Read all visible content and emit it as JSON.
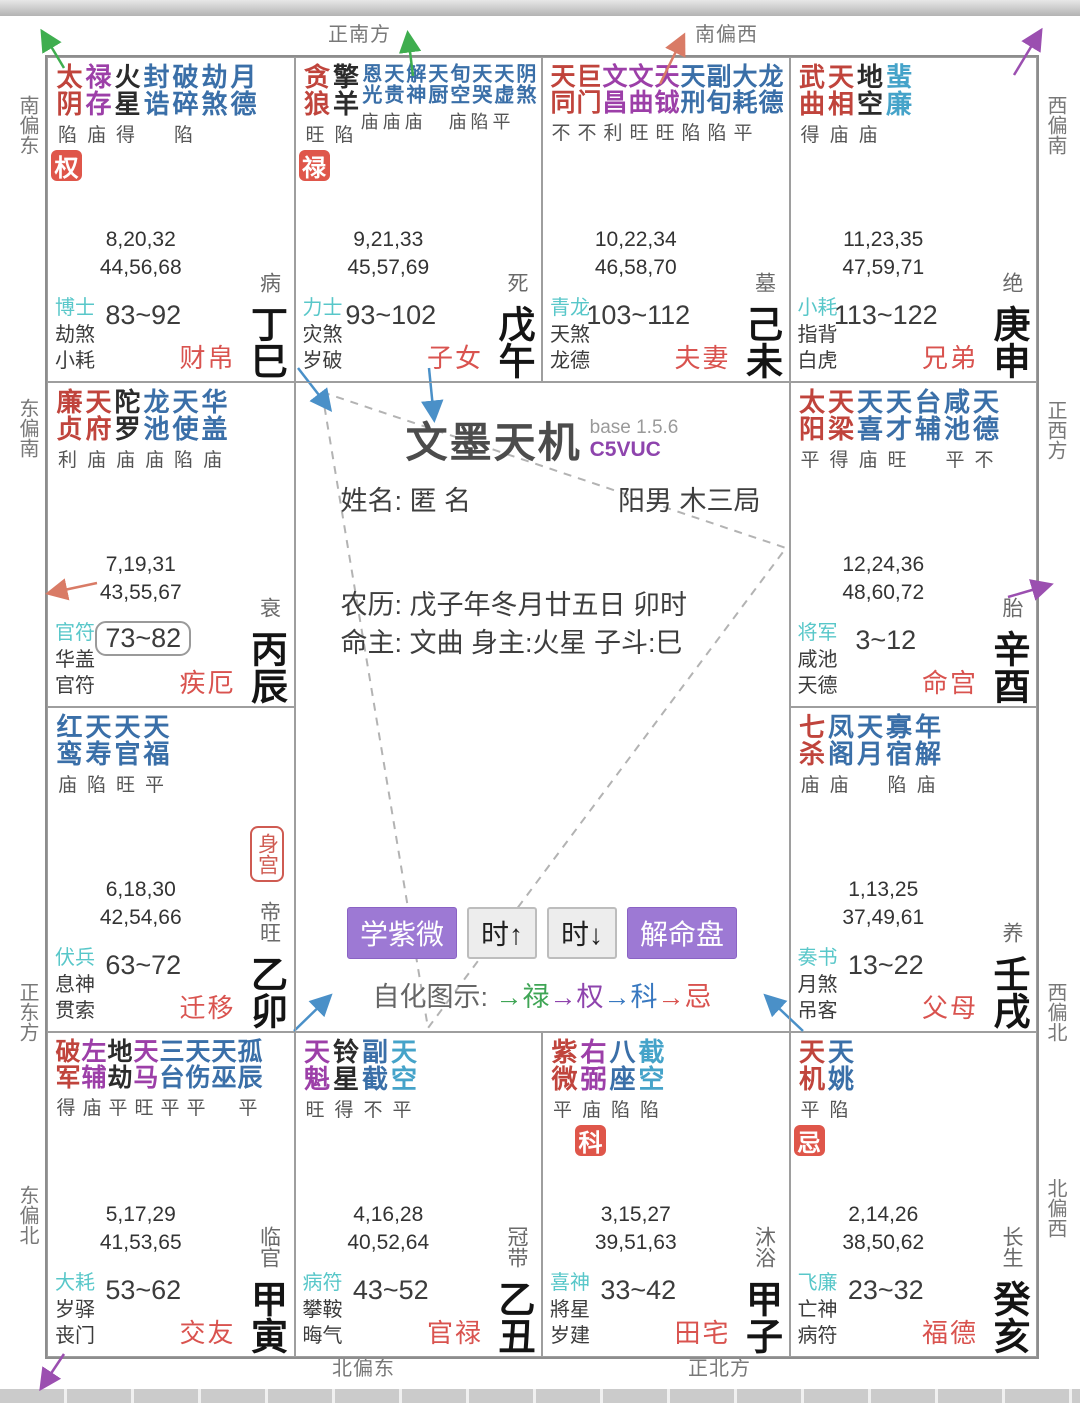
{
  "app": {
    "title": "文墨天机",
    "version": "base 1.5.6",
    "code": "C5VUC"
  },
  "info": {
    "name_line": "姓名: 匿 名",
    "gender_bureau": "阳男 木三局",
    "lunar": "农历: 戊子年冬月廿五日 卯时",
    "masters": "命主: 文曲 身主:火星 子斗:巳"
  },
  "toolbar": {
    "buttons": [
      {
        "label": "学紫微"
      },
      {
        "label": "时↑"
      },
      {
        "label": "时↓"
      },
      {
        "label": "解命盘"
      }
    ]
  },
  "legend": {
    "label": "自化图示:",
    "items": [
      {
        "text": "→禄",
        "color": "#3fa555"
      },
      {
        "text": "→权",
        "color": "#8e44ad"
      },
      {
        "text": "→科",
        "color": "#3878c0"
      },
      {
        "text": "→忌",
        "color": "#d9534f"
      }
    ]
  },
  "compass": {
    "top": [
      "正南方",
      "南偏西"
    ],
    "bottom": [
      "北偏东",
      "正北方"
    ],
    "left": [
      "南偏东",
      "东偏南",
      "正东方",
      "东偏北"
    ],
    "right": [
      "西偏南",
      "正西方",
      "西偏北",
      "北偏西"
    ]
  },
  "colors": {
    "major_star": "#c0443c",
    "lucky_star": "#9c3fa8",
    "malefic_star": "#2b2b2b",
    "minor_star": "#3a6fa8",
    "minor_star_light": "#45a3c9",
    "hua_badge": "#df564a",
    "deity": "#58c7c9",
    "palace_name": "#d9534f",
    "accent_purple": "#9d79d4"
  },
  "palaces": [
    {
      "branch": "si",
      "col": 1,
      "row": 1,
      "stars": [
        {
          "n": "太阴",
          "c": "major",
          "b": "陷"
        },
        {
          "n": "禄存",
          "c": "lucky",
          "b": "庙"
        },
        {
          "n": "火星",
          "c": "malefic",
          "b": "得"
        },
        {
          "n": "封诰",
          "c": "minor",
          "b": ""
        },
        {
          "n": "破碎",
          "c": "minor",
          "b": "陷"
        },
        {
          "n": "劫煞",
          "c": "minor",
          "b": ""
        },
        {
          "n": "月德",
          "c": "minor",
          "b": ""
        }
      ],
      "hua": {
        "label": "权",
        "col": 0
      },
      "numbers": [
        "8,20,32",
        "44,56,68"
      ],
      "deities": [
        "博士",
        "劫煞",
        "小耗"
      ],
      "range": "83~92",
      "boxed": false,
      "stage": "病",
      "name": "财帛",
      "stem": "丁巳"
    },
    {
      "branch": "wu",
      "col": 2,
      "row": 1,
      "stars": [
        {
          "n": "贪狼",
          "c": "major",
          "b": "旺"
        },
        {
          "n": "擎羊",
          "c": "malefic",
          "b": "陷"
        },
        {
          "n": "恩光",
          "c": "minor",
          "b": "庙",
          "s": "sm"
        },
        {
          "n": "天贵",
          "c": "minor",
          "b": "庙",
          "s": "sm"
        },
        {
          "n": "解神",
          "c": "minor",
          "b": "庙",
          "s": "sm"
        },
        {
          "n": "天厨",
          "c": "minor",
          "b": "",
          "s": "sm"
        },
        {
          "n": "旬空",
          "c": "minor",
          "b": "庙",
          "s": "sm"
        },
        {
          "n": "天哭",
          "c": "minor",
          "b": "陷",
          "s": "sm"
        },
        {
          "n": "天虚",
          "c": "minor",
          "b": "平",
          "s": "sm"
        },
        {
          "n": "阴煞",
          "c": "minor",
          "b": "",
          "s": "sm"
        }
      ],
      "hua": {
        "label": "禄",
        "col": 0
      },
      "numbers": [
        "9,21,33",
        "45,57,69"
      ],
      "deities": [
        "力士",
        "灾煞",
        "岁破"
      ],
      "range": "93~102",
      "boxed": false,
      "stage": "死",
      "name": "子女",
      "stem": "戊午"
    },
    {
      "branch": "wei",
      "col": 3,
      "row": 1,
      "tight": true,
      "stars": [
        {
          "n": "天同",
          "c": "major",
          "b": "不"
        },
        {
          "n": "巨门",
          "c": "major",
          "b": "不"
        },
        {
          "n": "文昌",
          "c": "lucky",
          "b": "利"
        },
        {
          "n": "文曲",
          "c": "lucky",
          "b": "旺"
        },
        {
          "n": "天钺",
          "c": "lucky",
          "b": "旺"
        },
        {
          "n": "天刑",
          "c": "minor",
          "b": "陷"
        },
        {
          "n": "副旬",
          "c": "minor",
          "b": "陷"
        },
        {
          "n": "大耗",
          "c": "minor",
          "b": "平"
        },
        {
          "n": "龙德",
          "c": "minor",
          "b": ""
        }
      ],
      "numbers": [
        "10,22,34",
        "46,58,70"
      ],
      "deities": [
        "青龙",
        "天煞",
        "龙德"
      ],
      "range": "103~112",
      "boxed": false,
      "stage": "墓",
      "name": "夫妻",
      "stem": "己未"
    },
    {
      "branch": "shen",
      "col": 4,
      "row": 1,
      "stars": [
        {
          "n": "武曲",
          "c": "major",
          "b": "得"
        },
        {
          "n": "天相",
          "c": "major",
          "b": "庙"
        },
        {
          "n": "地空",
          "c": "malefic",
          "b": "庙"
        },
        {
          "n": "蜚廉",
          "c": "minor2",
          "b": ""
        }
      ],
      "numbers": [
        "11,23,35",
        "47,59,71"
      ],
      "deities": [
        "小耗",
        "指背",
        "白虎"
      ],
      "range": "113~122",
      "boxed": false,
      "stage": "绝",
      "name": "兄弟",
      "stem": "庚申"
    },
    {
      "branch": "chen",
      "col": 1,
      "row": 2,
      "stars": [
        {
          "n": "廉贞",
          "c": "major",
          "b": "利"
        },
        {
          "n": "天府",
          "c": "major",
          "b": "庙"
        },
        {
          "n": "陀罗",
          "c": "malefic",
          "b": "庙"
        },
        {
          "n": "龙池",
          "c": "minor",
          "b": "庙"
        },
        {
          "n": "天使",
          "c": "minor",
          "b": "陷"
        },
        {
          "n": "华盖",
          "c": "minor",
          "b": "庙"
        }
      ],
      "numbers": [
        "7,19,31",
        "43,55,67"
      ],
      "deities": [
        "官符",
        "华盖",
        "官符"
      ],
      "range": "73~82",
      "boxed": true,
      "stage": "衰",
      "name": "疾厄",
      "stem": "丙辰"
    },
    {
      "branch": "you",
      "col": 4,
      "row": 2,
      "stars": [
        {
          "n": "太阳",
          "c": "major",
          "b": "平"
        },
        {
          "n": "天梁",
          "c": "major",
          "b": "得"
        },
        {
          "n": "天喜",
          "c": "minor",
          "b": "庙"
        },
        {
          "n": "天才",
          "c": "minor",
          "b": "旺"
        },
        {
          "n": "台辅",
          "c": "minor",
          "b": ""
        },
        {
          "n": "咸池",
          "c": "minor",
          "b": "平"
        },
        {
          "n": "天德",
          "c": "minor",
          "b": "不"
        }
      ],
      "numbers": [
        "12,24,36",
        "48,60,72"
      ],
      "deities": [
        "将军",
        "咸池",
        "天德"
      ],
      "range": "3~12",
      "boxed": false,
      "stage": "胎",
      "name": "命宫",
      "stem": "辛酉"
    },
    {
      "branch": "mao",
      "col": 1,
      "row": 3,
      "shen_gong": "身宫",
      "stars": [
        {
          "n": "红鸾",
          "c": "minor",
          "b": "庙"
        },
        {
          "n": "天寿",
          "c": "minor",
          "b": "陷"
        },
        {
          "n": "天官",
          "c": "minor",
          "b": "旺"
        },
        {
          "n": "天福",
          "c": "minor",
          "b": "平"
        }
      ],
      "numbers": [
        "6,18,30",
        "42,54,66"
      ],
      "deities": [
        "伏兵",
        "息神",
        "贯索"
      ],
      "range": "63~72",
      "boxed": false,
      "stage": "帝旺",
      "name": "迁移",
      "stem": "乙卯"
    },
    {
      "branch": "xu",
      "col": 4,
      "row": 3,
      "stars": [
        {
          "n": "七杀",
          "c": "major",
          "b": "庙"
        },
        {
          "n": "凤阁",
          "c": "minor",
          "b": "庙"
        },
        {
          "n": "天月",
          "c": "minor",
          "b": ""
        },
        {
          "n": "寡宿",
          "c": "minor",
          "b": "陷"
        },
        {
          "n": "年解",
          "c": "minor",
          "b": "庙"
        }
      ],
      "numbers": [
        "1,13,25",
        "37,49,61"
      ],
      "deities": [
        "奏书",
        "月煞",
        "吊客"
      ],
      "range": "13~22",
      "boxed": false,
      "stage": "养",
      "name": "父母",
      "stem": "壬戌"
    },
    {
      "branch": "yin",
      "col": 1,
      "row": 4,
      "tight": true,
      "stars": [
        {
          "n": "破军",
          "c": "major",
          "b": "得"
        },
        {
          "n": "左辅",
          "c": "lucky",
          "b": "庙"
        },
        {
          "n": "地劫",
          "c": "malefic",
          "b": "平"
        },
        {
          "n": "天马",
          "c": "lucky",
          "b": "旺"
        },
        {
          "n": "三台",
          "c": "minor",
          "b": "平"
        },
        {
          "n": "天伤",
          "c": "minor",
          "b": "平"
        },
        {
          "n": "天巫",
          "c": "minor",
          "b": ""
        },
        {
          "n": "孤辰",
          "c": "minor",
          "b": "平"
        }
      ],
      "numbers": [
        "5,17,29",
        "41,53,65"
      ],
      "deities": [
        "大耗",
        "岁驿",
        "丧门"
      ],
      "range": "53~62",
      "boxed": false,
      "stage": "临官",
      "name": "交友",
      "stem": "甲寅"
    },
    {
      "branch": "chou",
      "col": 2,
      "row": 4,
      "stars": [
        {
          "n": "天魁",
          "c": "lucky",
          "b": "旺"
        },
        {
          "n": "铃星",
          "c": "malefic",
          "b": "得"
        },
        {
          "n": "副截",
          "c": "minor",
          "b": "不"
        },
        {
          "n": "天空",
          "c": "minor2",
          "b": "平"
        }
      ],
      "numbers": [
        "4,16,28",
        "40,52,64"
      ],
      "deities": [
        "病符",
        "攀鞍",
        "晦气"
      ],
      "range": "43~52",
      "boxed": false,
      "stage": "冠带",
      "name": "官禄",
      "stem": "乙丑"
    },
    {
      "branch": "zi",
      "col": 3,
      "row": 4,
      "stars": [
        {
          "n": "紫微",
          "c": "major",
          "b": "平"
        },
        {
          "n": "右弼",
          "c": "lucky",
          "b": "庙"
        },
        {
          "n": "八座",
          "c": "minor",
          "b": "陷"
        },
        {
          "n": "截空",
          "c": "minor2",
          "b": "陷"
        }
      ],
      "hua": {
        "label": "科",
        "col": 1
      },
      "numbers": [
        "3,15,27",
        "39,51,63"
      ],
      "deities": [
        "喜神",
        "將星",
        "岁建"
      ],
      "range": "33~42",
      "boxed": false,
      "stage": "沐浴",
      "name": "田宅",
      "stem": "甲子"
    },
    {
      "branch": "hai",
      "col": 4,
      "row": 4,
      "stars": [
        {
          "n": "天机",
          "c": "major",
          "b": "平"
        },
        {
          "n": "天姚",
          "c": "minor",
          "b": "陷"
        }
      ],
      "hua": {
        "label": "忌",
        "col": 0
      },
      "numbers": [
        "2,14,26",
        "38,50,62"
      ],
      "deities": [
        "飞廉",
        "亡神",
        "病符"
      ],
      "range": "23~32",
      "boxed": false,
      "stage": "长生",
      "name": "福德",
      "stem": "癸亥"
    }
  ]
}
